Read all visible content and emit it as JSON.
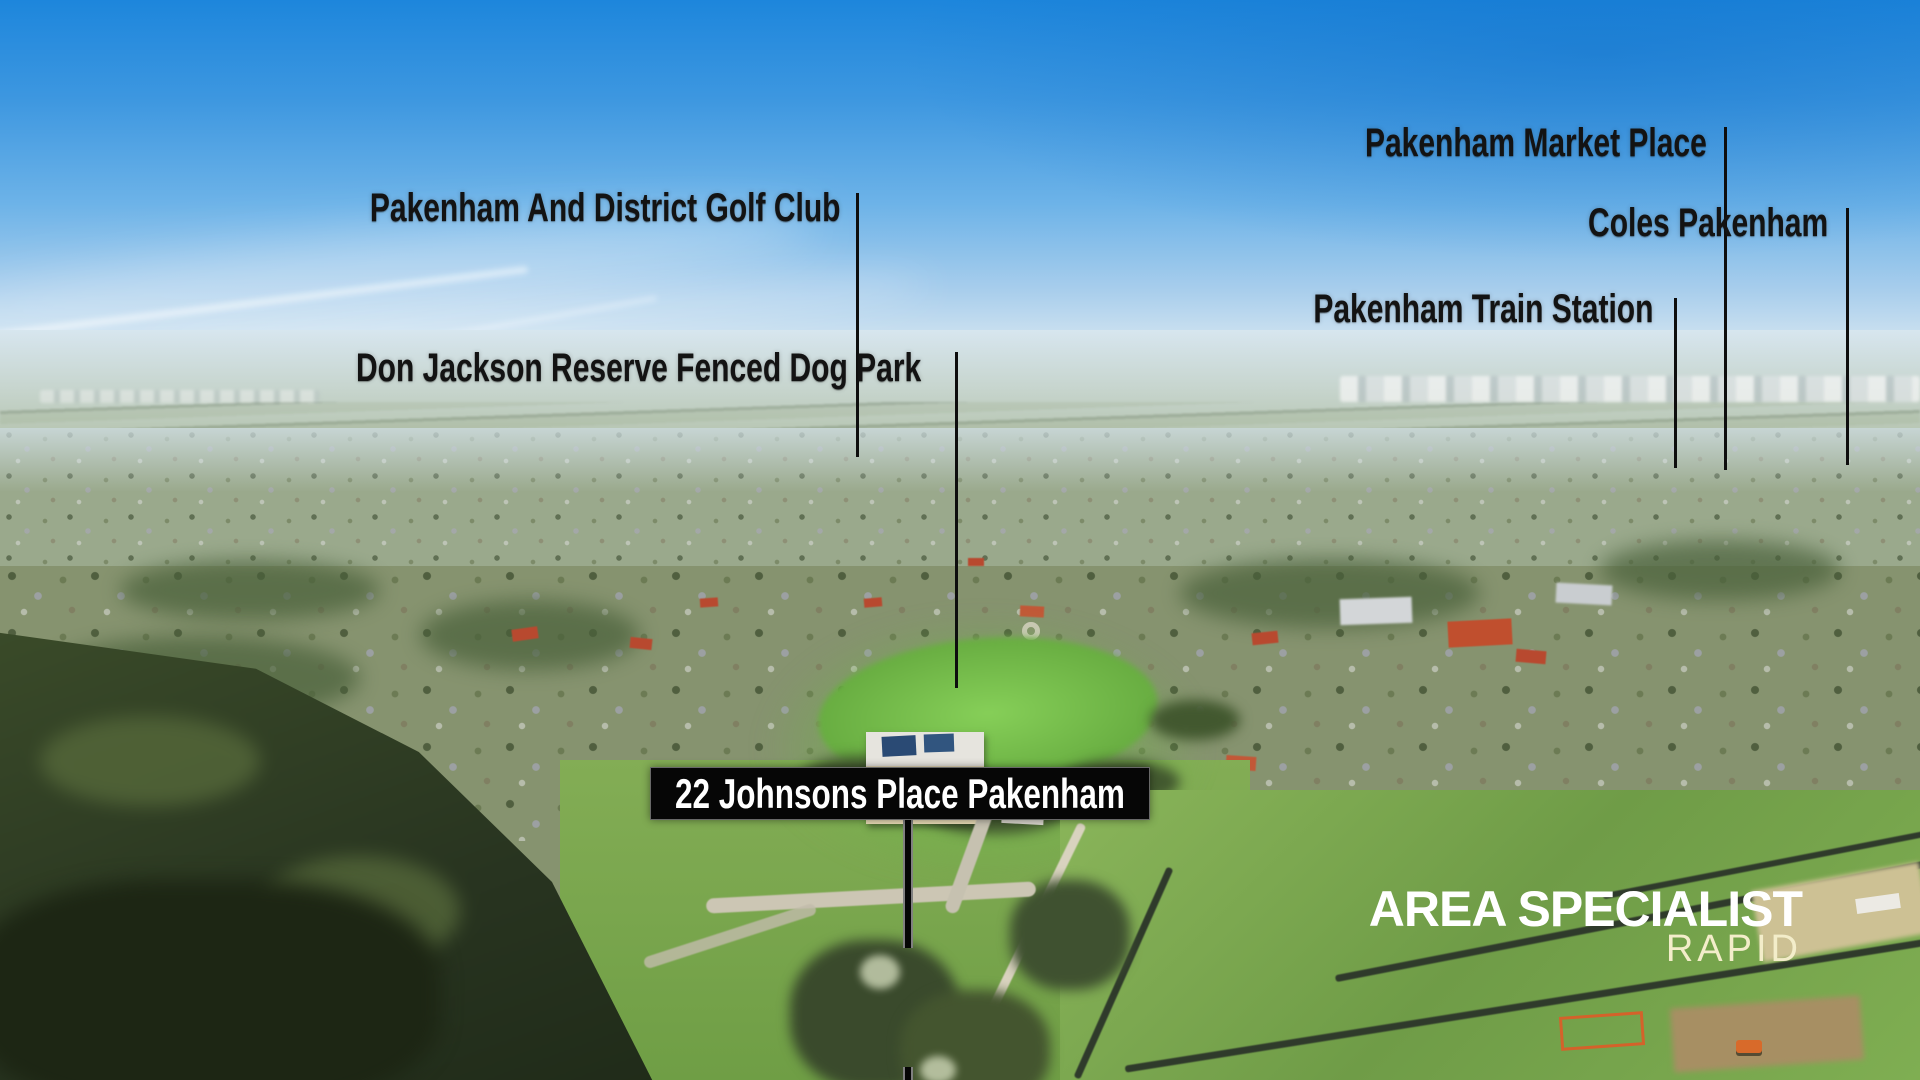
{
  "scene": {
    "description": "Aerial drone photograph over Pakenham suburbs with location annotations",
    "sky_top_color": "#1d86dc",
    "sky_horizon_color": "#d7e7f1",
    "reserve_green": "#86cf58",
    "forest_green": "#283420",
    "paddock_green": "#7fae52"
  },
  "annotations": {
    "text_color": "#131313",
    "line_color": "#0e0e0e",
    "labels": [
      {
        "id": "golf-club",
        "text": "Pakenham And District Golf Club"
      },
      {
        "id": "dog-park",
        "text": "Don Jackson Reserve Fenced Dog Park"
      },
      {
        "id": "market-place",
        "text": "Pakenham Market Place"
      },
      {
        "id": "coles",
        "text": "Coles Pakenham"
      },
      {
        "id": "train-station",
        "text": "Pakenham Train Station"
      }
    ],
    "property": {
      "label": "22 Johnsons Place Pakenham",
      "bg_color": "#060606",
      "text_color": "#ffffff"
    }
  },
  "branding": {
    "name": "AREA SPECIALIST",
    "tagline": "RAPID",
    "name_color": "#ffffff",
    "tagline_color": "#f3edca"
  }
}
